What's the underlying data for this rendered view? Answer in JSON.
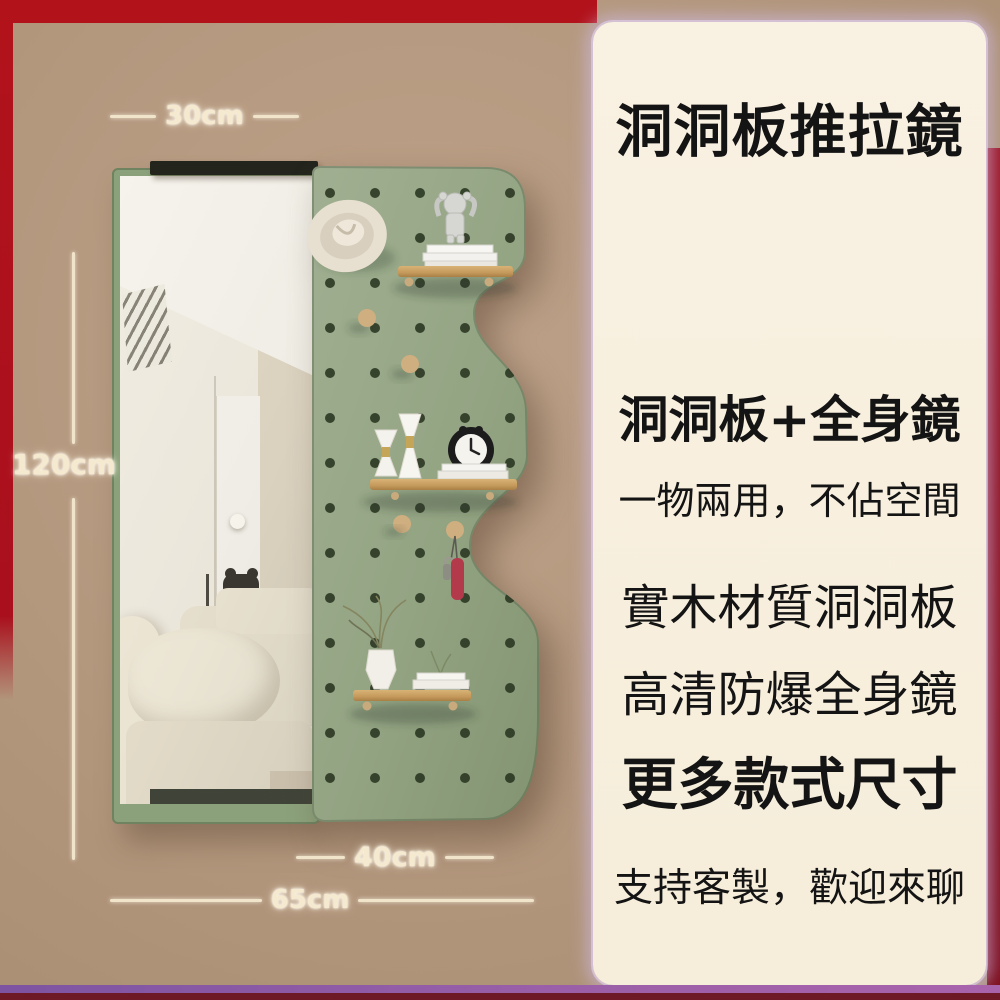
{
  "product_panel": {
    "title": "洞洞板推拉鏡",
    "features": [
      {
        "text": "洞洞板+全身鏡"
      },
      {
        "text": "一物兩用，不佔空間"
      },
      {
        "text": "實木材質洞洞板"
      },
      {
        "text": "高清防爆全身鏡"
      },
      {
        "text": "更多款式尺寸"
      },
      {
        "text": "支持客製，歡迎來聊"
      }
    ]
  },
  "dimension_labels": {
    "mirror_width": "30cm",
    "height": "120cm",
    "pegboard_width": "40cm",
    "total_width": "65cm"
  },
  "colors": {
    "background_tan": "#b3977d",
    "panel_cream": "#f8f0df",
    "pegboard_green": "#93a483",
    "frame_red": "#b2131b",
    "side_maroon": "#8c1120",
    "bottom_purple": "#8a5bab",
    "shelf_wood": "#c9a265",
    "dimension_text": "#f5e9cf",
    "panel_text": "#141414"
  }
}
